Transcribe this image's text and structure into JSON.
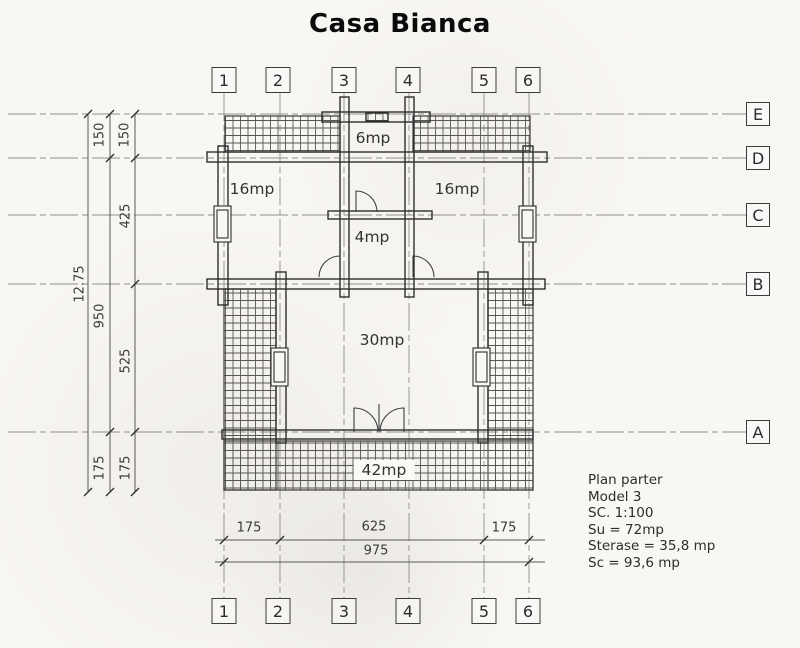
{
  "page": {
    "title": "Casa Bianca"
  },
  "grid": {
    "columns": [
      "1",
      "2",
      "3",
      "4",
      "5",
      "6"
    ],
    "rows": [
      "E",
      "D",
      "C",
      "B",
      "A"
    ]
  },
  "dimensions": {
    "vertical_total": "12.75",
    "vertical_mid": [
      "150",
      "950",
      "175"
    ],
    "vertical_inner": [
      "150",
      "425",
      "525",
      "175"
    ],
    "horizontal_segments": [
      "175",
      "625",
      "175"
    ],
    "horizontal_total": "975"
  },
  "rooms": {
    "porch_top": "6mp",
    "room_left": "16mp",
    "room_right": "16mp",
    "hall": "4mp",
    "living": "30mp",
    "terrace": "42mp"
  },
  "info_block": {
    "lines": [
      "Plan parter",
      "Model 3",
      "SC. 1:100",
      "Su = 72mp",
      "Sterase = 35,8 mp",
      "Sc = 93,6 mp"
    ]
  },
  "colors": {
    "paper": "#f9f7f3",
    "ink": "#2e2e2e",
    "grid_line": "#8f8f8f"
  }
}
